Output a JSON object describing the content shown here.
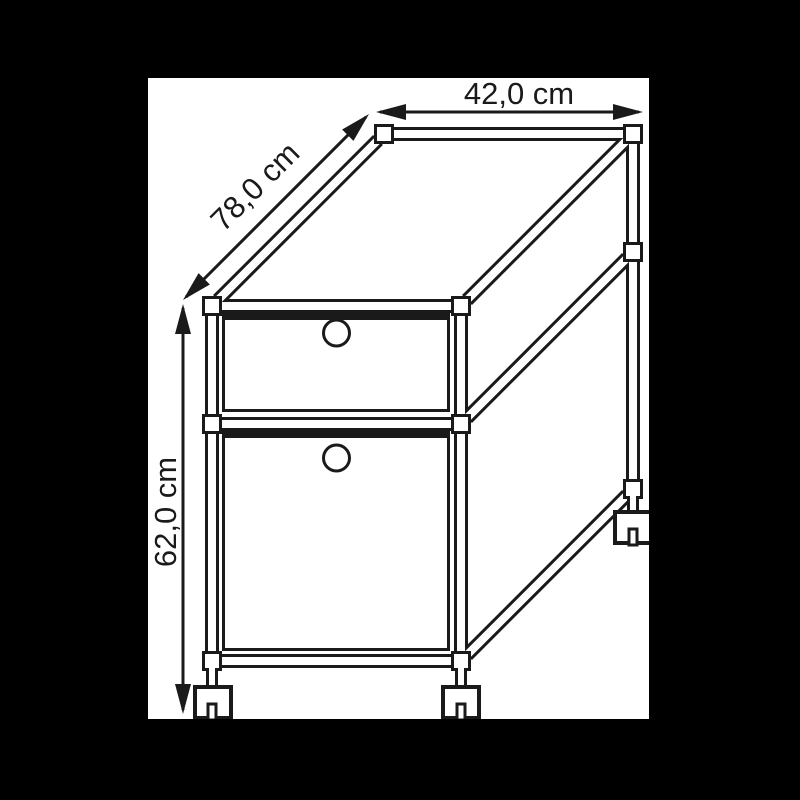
{
  "drawing": {
    "background_color": "#000000",
    "canvas_color": "#ffffff",
    "line_color": "#1a1a1a",
    "dimensions": {
      "width_label": "42,0 cm",
      "depth_label": "78,0 cm",
      "height_label": "62,0 cm"
    }
  }
}
